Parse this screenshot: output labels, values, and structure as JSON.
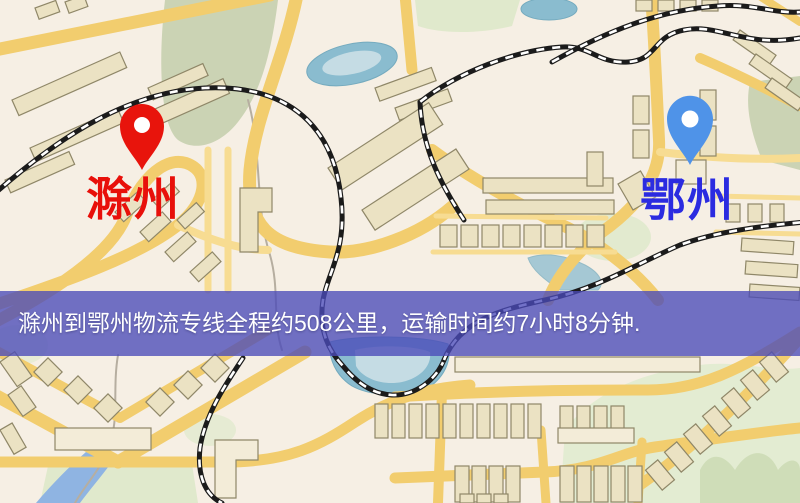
{
  "map": {
    "origin_label": "滁州",
    "destination_label": "鄂州",
    "origin_marker": "red-location-pin",
    "destination_marker": "blue-location-pin"
  },
  "banner": {
    "text": "滁州到鄂州物流专线全程约508公里，运输时间约7小时8分钟."
  },
  "colors": {
    "map-bg": "#f6efe4",
    "road": "#f2cd6e",
    "road-light": "#f7dc92",
    "building": "#ebe2c3",
    "building-light": "#f3ecd8",
    "building-stroke": "#8f8768",
    "park": "#cbd3b4",
    "park-light": "#e0e9cc",
    "park-pale": "#e3ecd2",
    "park-dark": "#cfddb8",
    "water": "#8abccf",
    "water-light": "#c5dce4",
    "water-river": "#8fb4e2",
    "rail": "#1b1b1b",
    "pin-red": "#e8140c",
    "pin-blue": "#4f93e8",
    "label-red": "#e8100a",
    "label-blue": "#2b2be0",
    "banner-bg": "#4a4ab8",
    "banner-text": "#ffffff"
  }
}
